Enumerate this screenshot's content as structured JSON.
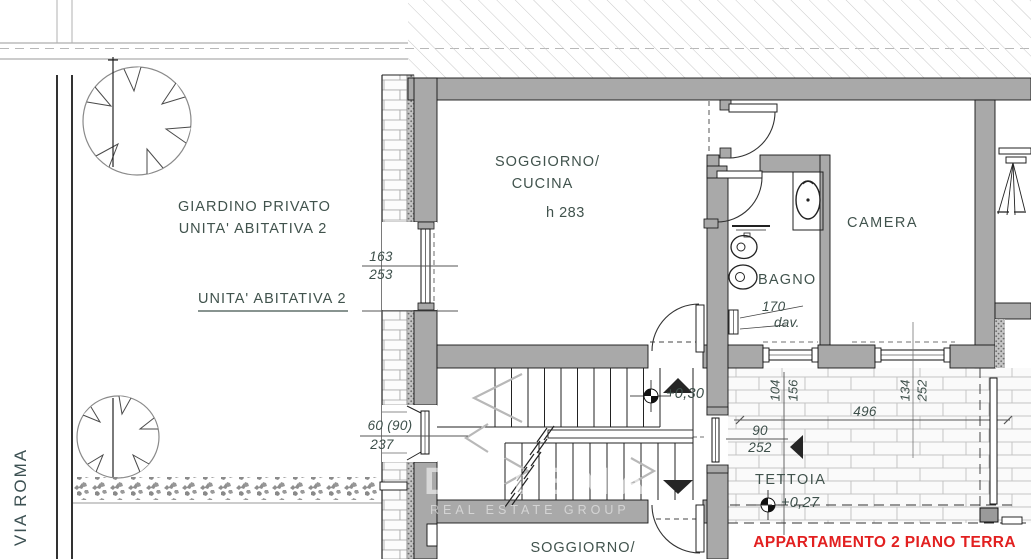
{
  "plan": {
    "street": {
      "name": "VIA ROMA"
    },
    "garden": {
      "line1": "GIARDINO PRIVATO",
      "line2": "UNITA' ABITATIVA 2",
      "unit_label": "UNITA' ABITATIVA 2"
    },
    "rooms": {
      "soggiorno_line1": "SOGGIORNO/",
      "soggiorno_line2": "CUCINA",
      "soggiorno_height": "h 283",
      "camera": "CAMERA",
      "bagno": "BAGNO",
      "tettoia": "TETTOIA",
      "lower_soggiorno": "SOGGIORNO/"
    },
    "levels": {
      "hall": "+0,30",
      "tettoia": "+0,27"
    },
    "dims": {
      "win1_w": "163",
      "win1_h": "253",
      "win2_w": "60 (90)",
      "win2_h": "237",
      "door_w": "90",
      "door_h": "252",
      "bagno_win": "170",
      "bagno_sill": "dav.",
      "span": "496",
      "d104": "104",
      "d156": "156",
      "d134": "134",
      "d252": "252"
    },
    "footer": {
      "title": "APPARTAMENTO 2 PIANO TERRA"
    },
    "watermark": {
      "name": "DIALEMA",
      "tagline": "REAL ESTATE GROUP"
    },
    "colors": {
      "wall": "#a9a9a9",
      "label": "#41534d",
      "accent": "#e22020"
    }
  }
}
